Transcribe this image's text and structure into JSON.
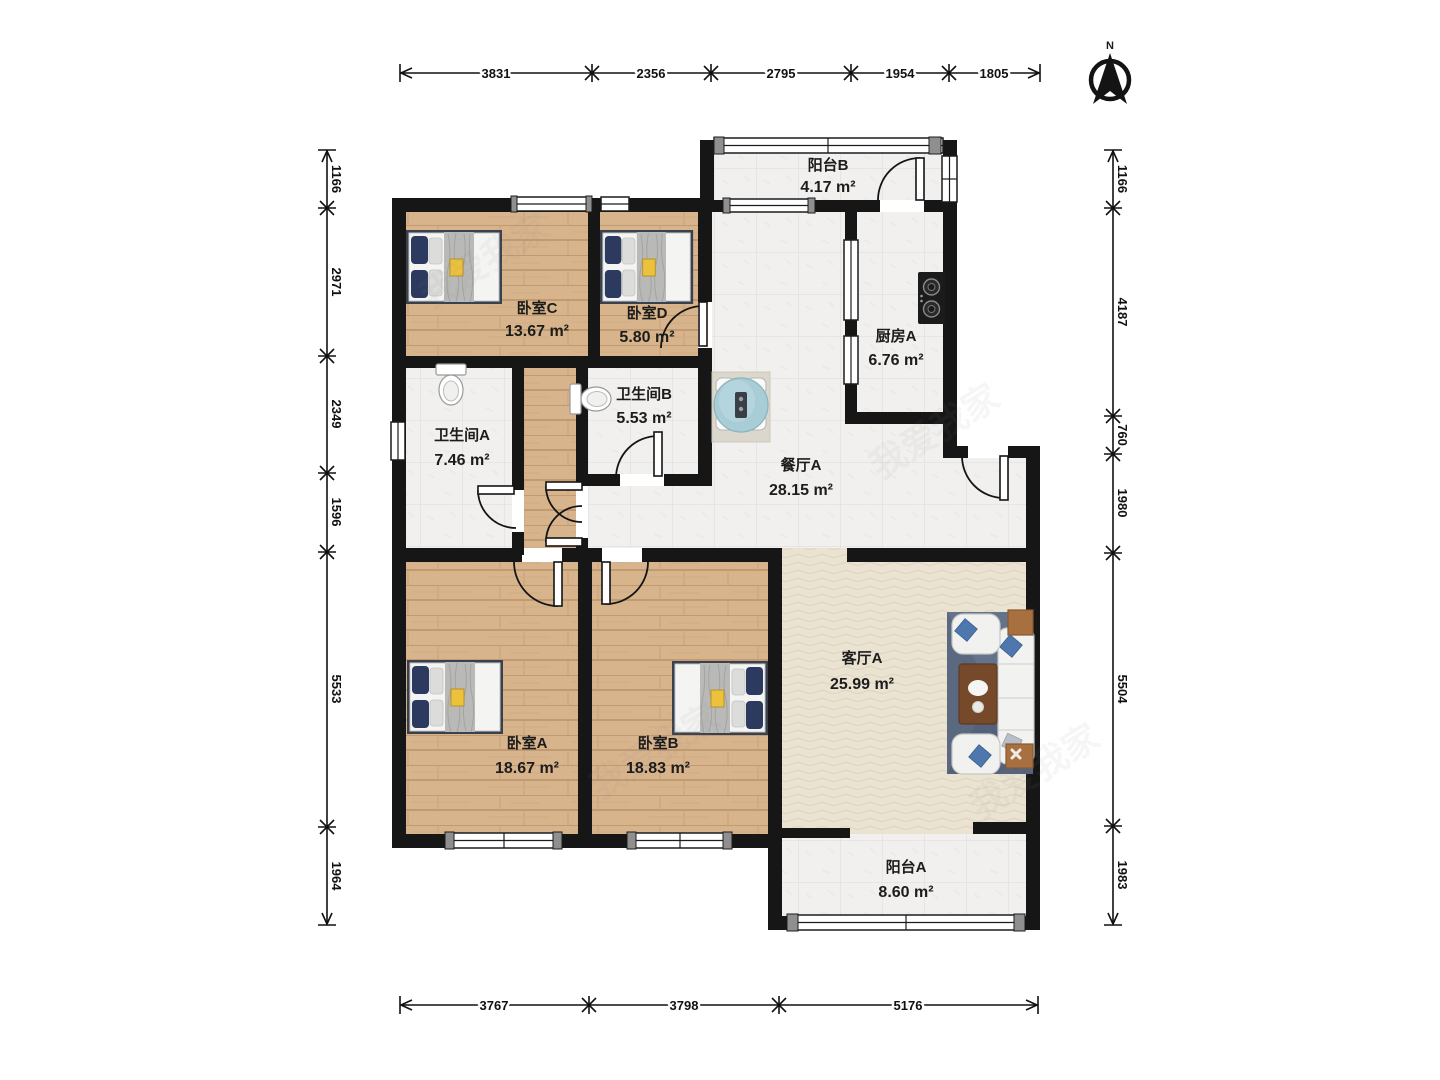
{
  "north": {
    "label": "N"
  },
  "watermark": {
    "text": "我爱我家"
  },
  "rooms": {
    "balcony_b": {
      "name": "阳台B",
      "area": "4.17 m²"
    },
    "bedroom_c": {
      "name": "卧室C",
      "area": "13.67 m²"
    },
    "bedroom_d": {
      "name": "卧室D",
      "area": "5.80 m²"
    },
    "kitchen_a": {
      "name": "厨房A",
      "area": "6.76 m²"
    },
    "bathroom_a": {
      "name": "卫生间A",
      "area": "7.46 m²"
    },
    "bathroom_b": {
      "name": "卫生间B",
      "area": "5.53 m²"
    },
    "dining_a": {
      "name": "餐厅A",
      "area": "28.15 m²"
    },
    "living_a": {
      "name": "客厅A",
      "area": "25.99 m²"
    },
    "bedroom_a": {
      "name": "卧室A",
      "area": "18.67 m²"
    },
    "bedroom_b": {
      "name": "卧室B",
      "area": "18.83 m²"
    },
    "balcony_a": {
      "name": "阳台A",
      "area": "8.60 m²"
    }
  },
  "dimensions": {
    "top": [
      "3831",
      "2356",
      "2795",
      "1954",
      "1805"
    ],
    "bottom": [
      "3767",
      "3798",
      "5176"
    ],
    "left": [
      "1166",
      "2971",
      "2349",
      "1596",
      "5533",
      "1964"
    ],
    "right": [
      "1166",
      "4187",
      "760",
      "1980",
      "5504",
      "1983"
    ]
  },
  "colors": {
    "wall": "#161616",
    "wood_floor": "#d8b48c",
    "tile_floor": "#f1f0ee",
    "living_floor": "#ebe3d2",
    "bed_pillow": "#2b3a5e",
    "sofa_rug": "#5a6880",
    "dining_table": "#a9cdd6",
    "coffee_table": "#77492b",
    "accent_yellow": "#ecc23c"
  }
}
